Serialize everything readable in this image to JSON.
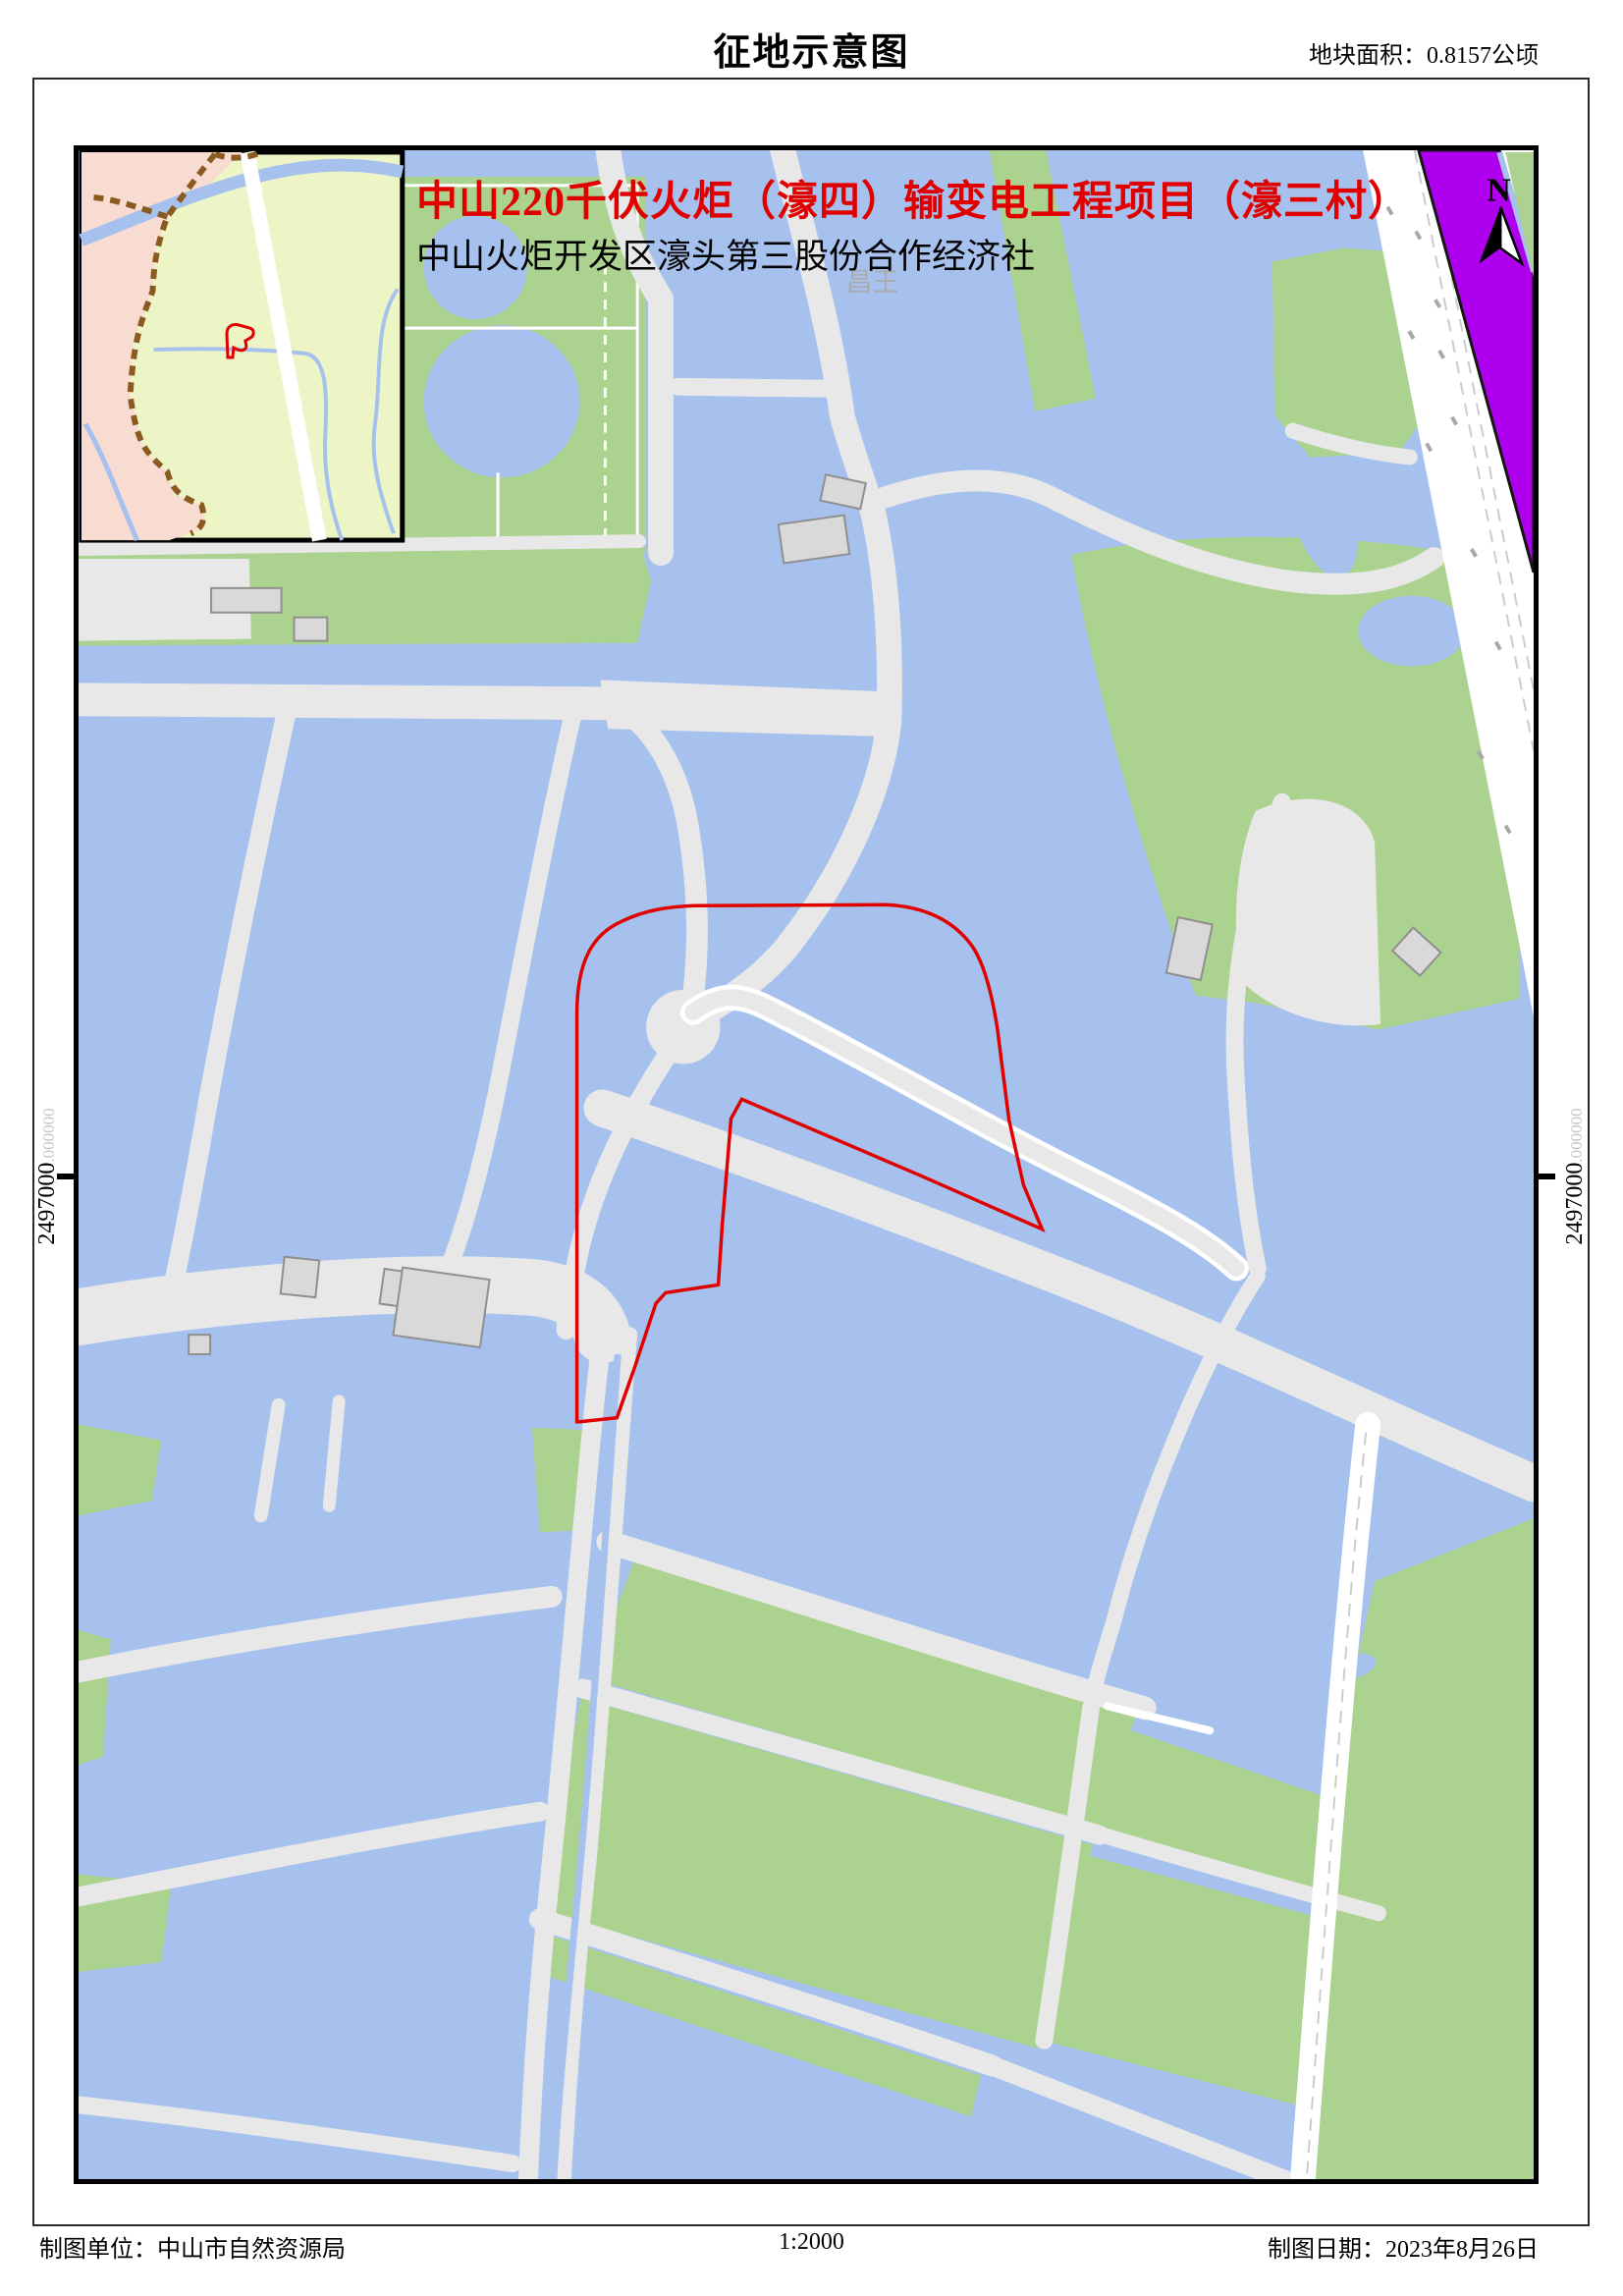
{
  "doc": {
    "title": "征地示意图",
    "area_label": "地块面积：0.8157公顷"
  },
  "map": {
    "project_title": "中山220千伏火炬（濠四）输变电工程项目（濠三村）",
    "subtitle": "中山火炬开发区濠头第三股份合作经济社",
    "place_label": "昌王",
    "north_label": "N",
    "coord_left": {
      "value": "2497000",
      "decimal": ".000000"
    },
    "coord_right": {
      "value": "2497000",
      "decimal": ".000000"
    }
  },
  "footer": {
    "agency": "制图单位：中山市自然资源局",
    "scale": "1:2000",
    "date": "制图日期：2023年8月26日"
  },
  "legend_semantics": {
    "red-outline": "acquisition parcel boundary",
    "red-shape-in-inset": "parcel location indicator",
    "blue": "fish ponds / water",
    "green": "vegetation / fields",
    "gray": "dike roads",
    "purple": "expressway corridor"
  },
  "colors": {
    "water": "#a6c1ee",
    "road": "#e8e8e8",
    "green": "#abd28e",
    "purple": "#ae00ef",
    "parcel_red": "#e00000",
    "inset_bg": "#edf5c6",
    "inset_pink": "#f8dcd2",
    "inset_boundary_brown": "#8a5a20"
  }
}
